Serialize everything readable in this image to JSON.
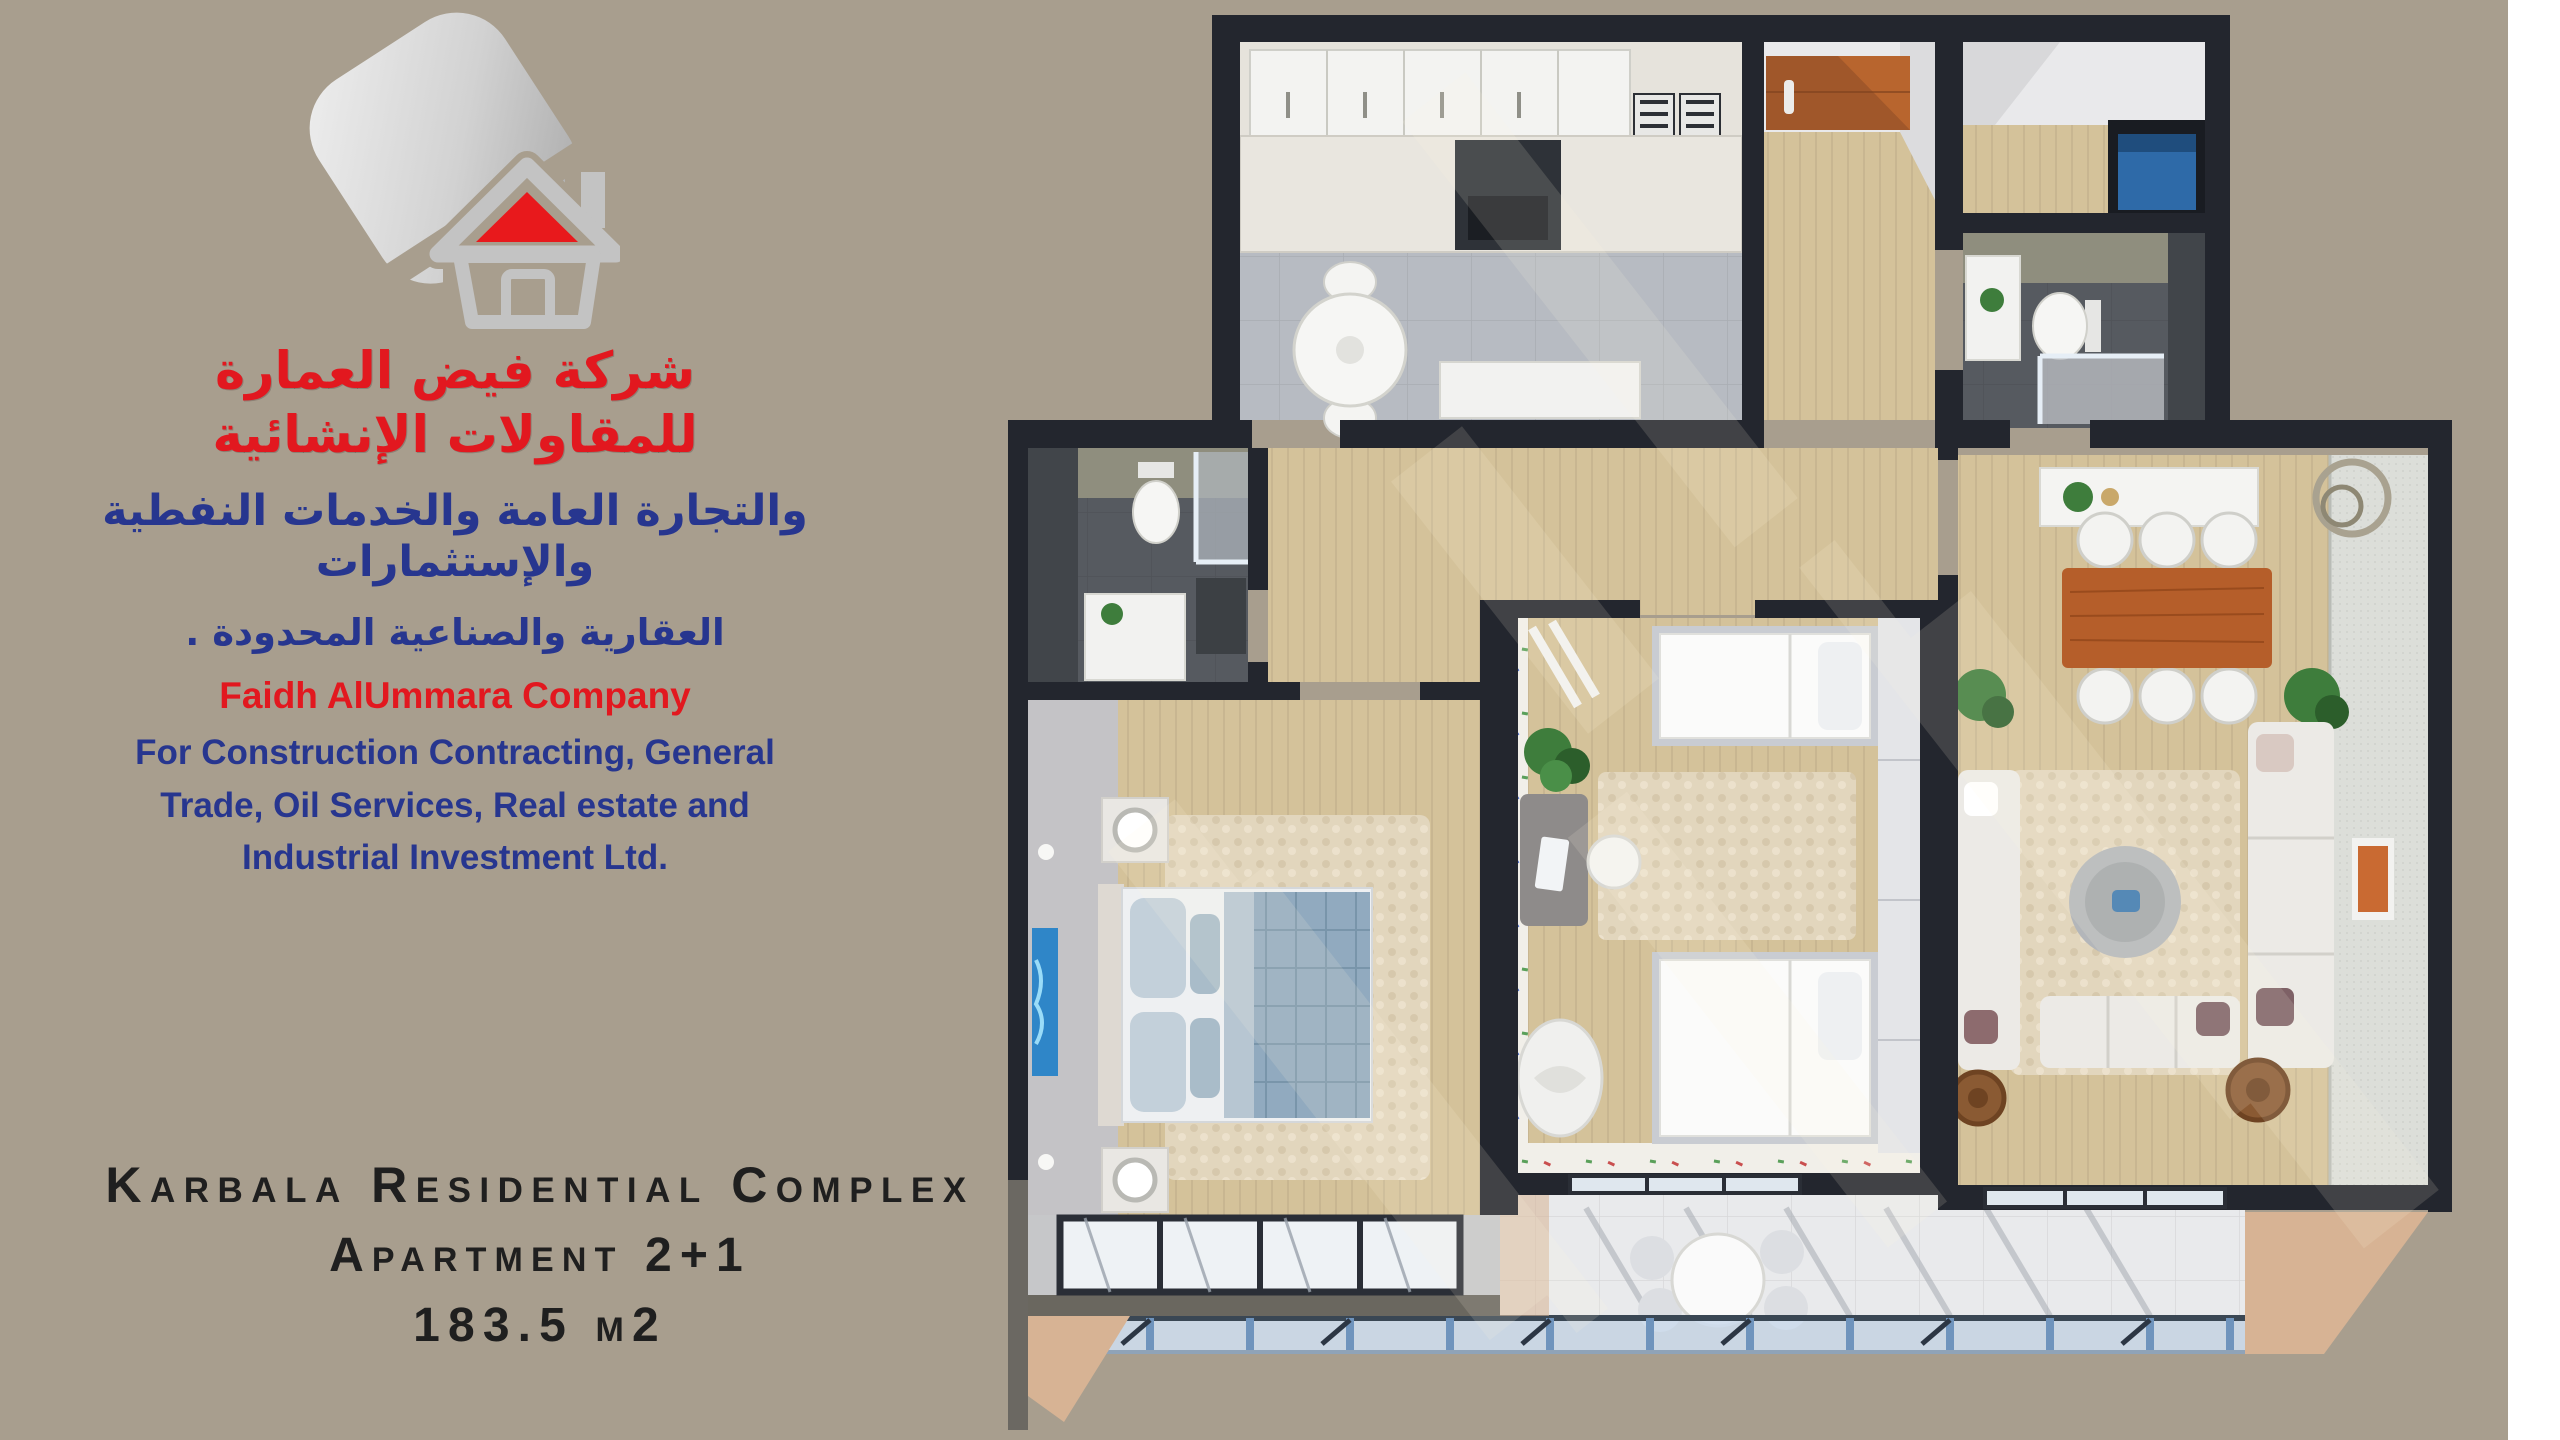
{
  "page": {
    "width": 2560,
    "height": 1440
  },
  "company": {
    "logo_name": "faidh-alummara-house-logo",
    "arabic_line1": "شركة فيض العمارة للمقاولات الإنشائية",
    "arabic_line2": "والتجارة العامة والخدمات النفطية والإستثمارات",
    "arabic_line3": "العقارية والصناعية المحدودة .",
    "name_en": "Faidh AlUmmara Company",
    "desc_en_line1": "For Construction Contracting, General",
    "desc_en_line2": "Trade, Oil Services, Real estate and",
    "desc_en_line3": "Industrial Investment Ltd.",
    "name_color": "#e2181f",
    "desc_color": "#27368f"
  },
  "project": {
    "title": "Karbala Residential Complex",
    "subtitle": "Apartment 2+1",
    "area": "183.5 m2",
    "text_color": "#1f1f1f"
  },
  "floor_plan": {
    "type": "3d-top-down-apartment-render",
    "rooms": [
      {
        "name": "kitchen"
      },
      {
        "name": "entry-hall"
      },
      {
        "name": "storage-closet"
      },
      {
        "name": "guest-bathroom"
      },
      {
        "name": "corridor"
      },
      {
        "name": "main-bathroom"
      },
      {
        "name": "master-bedroom"
      },
      {
        "name": "kids-bedroom"
      },
      {
        "name": "living-dining-room"
      },
      {
        "name": "balcony"
      }
    ],
    "palette": {
      "bg": "#a89e8e",
      "edge": "#ffffff",
      "wall": "#23262e",
      "wall_outer": "#6b6862",
      "parapet": "#6a675f",
      "wood": "#d4c29a",
      "kitchen_floor": "#b7bbc2",
      "marble": "#e6e3dc",
      "olive": "#8f8e7e",
      "slate": "#565a60",
      "dark_marble": "#41454a",
      "white_room": "#e9e9eb",
      "terrazzo": "#f1efe9",
      "wardrobe": "#e4e5e8",
      "balcony_floor": "#e9eaec",
      "concrete": "#c6c7c9",
      "railing_glass": "#cddcec",
      "railing_post": "#6f94bd",
      "window_glass": "#eef2f5",
      "window_frame": "#2a2e36",
      "entry_door": "#a0572a",
      "dining_table": "#b55e2a",
      "washer": "#2e6aa8",
      "plant": "#3e7d3c",
      "rug": "#e2d6bd",
      "sofa": "#eceae6",
      "bed_duvet": "#91aabf",
      "bed_pillow": "#c3d0da",
      "bedroom_gray_floor": "#c4c3c6",
      "textured_wall": "#dcded9",
      "tan_wedge": "#d7b394",
      "logo_gray": "#c6c6c6",
      "logo_red": "#e8191c"
    }
  }
}
